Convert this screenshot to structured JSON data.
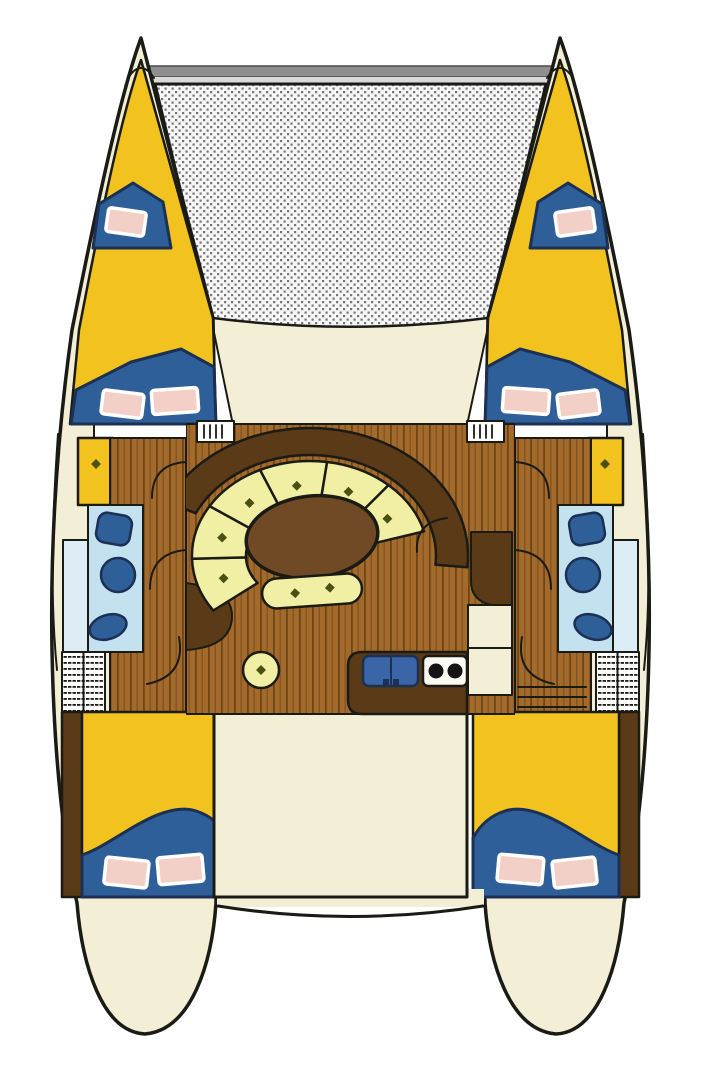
{
  "diagram": {
    "type": "deck-plan",
    "subject": "catamaran-interior-layout-plan",
    "view": "top-down"
  },
  "colors": {
    "background": "#ffffff",
    "outline": "#1b1b15",
    "hull": "#f3eed6",
    "cabin_yellow": "#f2c31f",
    "bedding_blue": "#2f5f98",
    "bedding_outline": "#1c3054",
    "pillow_pink": "#f2cfc7",
    "pillow_border": "#ffffff",
    "trampoline_base": "#f6f6f6",
    "trampoline_dot": "#757575",
    "beam_top": "#8f8f8f",
    "beam_bottom": "#d9d9d9",
    "wood_base": "#a26b2b",
    "wood_grain_dark": "#6f4516",
    "wood_grain_mid": "#845320",
    "furniture_brown": "#5a3a17",
    "table_brown": "#6f4a25",
    "cushion_pale": "#f1efa4",
    "button_olive": "#4a4f12",
    "bathroom_blue": "#c3e1ef",
    "shower_blue": "#dcedf6",
    "fixture_blue": "#2f5f98",
    "sink_blue": "#3a66a8",
    "stove_white": "#fbfaf3",
    "burner_black": "#141414",
    "hatch_white": "#ffffff",
    "step_white": "#ffffff"
  }
}
